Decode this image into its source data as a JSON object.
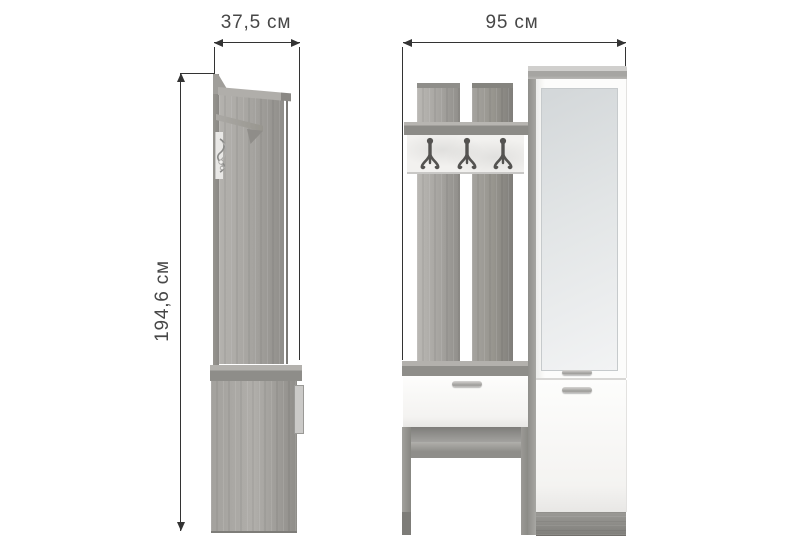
{
  "diagram": {
    "side_view": {
      "width_label": "37,5 см",
      "height_label": "194,6 см"
    },
    "front_view": {
      "width_label": "95 см",
      "hook_count": 3
    },
    "colors": {
      "background": "#ffffff",
      "dimension_line": "#333333",
      "dimension_text": "#474747",
      "wood_light": "#b7b5b1",
      "wood_mid": "#a3a19d",
      "wood_dark": "#8b8a86",
      "panel_white": "#fbfbfa",
      "mirror_gray": "#dde1e3",
      "hook_metal": "#545351"
    }
  }
}
